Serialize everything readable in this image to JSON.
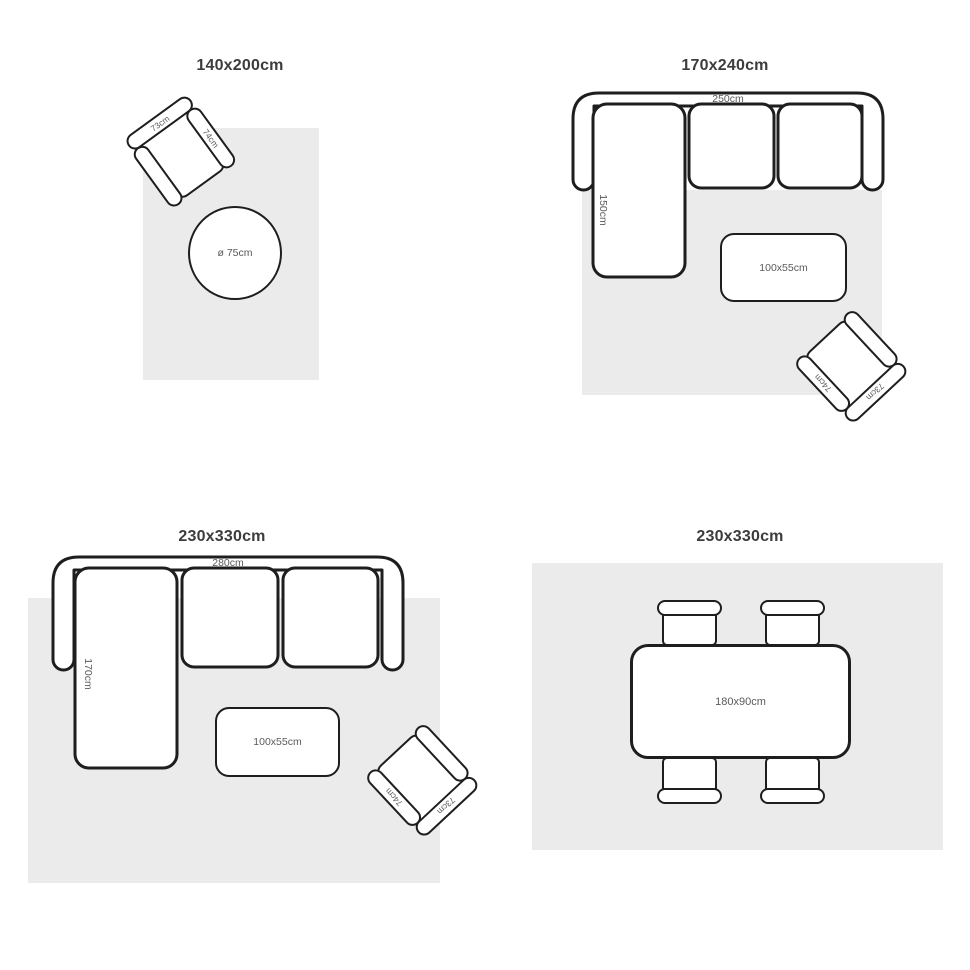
{
  "colors": {
    "background": "#ffffff",
    "rug_fill": "#ebebeb",
    "outline": "#1e1e1e",
    "title_text": "#3c3c3c",
    "label_text": "#5a5a5a"
  },
  "panels": [
    {
      "id": "rug-140x200",
      "title": "140x200cm",
      "armchair": {
        "back_label": "73cm",
        "arm_label": "74cm"
      },
      "round_table": {
        "label": "ø 75cm"
      }
    },
    {
      "id": "rug-170x240",
      "title": "170x240cm",
      "sofa": {
        "width_label": "250cm",
        "depth_label": "150cm"
      },
      "coffee_table": {
        "label": "100x55cm"
      },
      "armchair": {
        "back_label": "73cm",
        "arm_label": "74cm"
      }
    },
    {
      "id": "rug-230x330-sofa",
      "title": "230x330cm",
      "sofa": {
        "width_label": "280cm",
        "depth_label": "170cm"
      },
      "coffee_table": {
        "label": "100x55cm"
      },
      "armchair": {
        "back_label": "73cm",
        "arm_label": "74cm"
      }
    },
    {
      "id": "rug-230x330-dining",
      "title": "230x330cm",
      "dining_table": {
        "label": "180x90cm"
      }
    }
  ]
}
